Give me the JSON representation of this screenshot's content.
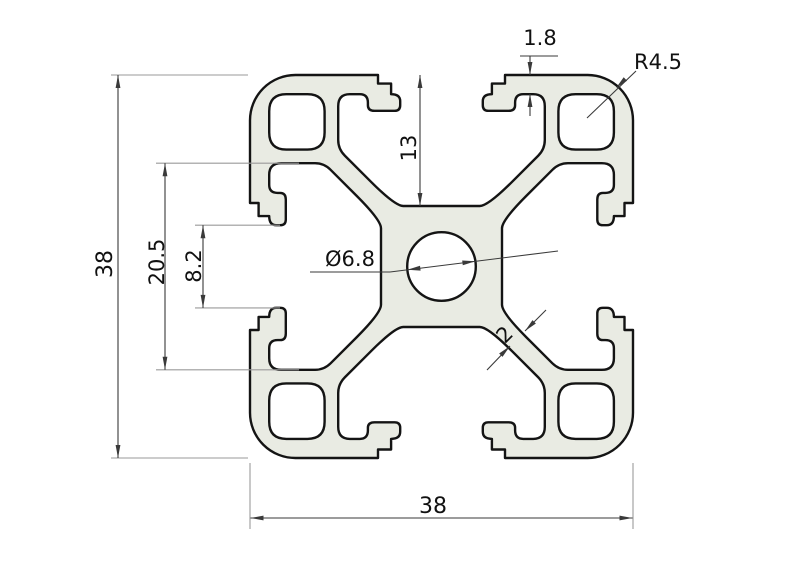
{
  "drawing": {
    "type": "aluminium-extrusion-profile-cross-section",
    "labels": {
      "overall_height": "38",
      "overall_width": "38",
      "slot_channel_width": "20.5",
      "slot_opening_width": "8.2",
      "slot_depth": "13",
      "lip_thickness": "1.8",
      "corner_radius": "R4.5",
      "center_hole_diameter": "Ø6.8",
      "web_thickness": "2"
    },
    "colors": {
      "background": "#ffffff",
      "profile_fill": "#e9ebe3",
      "profile_outline": "#141414",
      "dimension_line": "#3a3a3a",
      "extension_line": "#9a9a9a",
      "text": "#111111"
    }
  }
}
